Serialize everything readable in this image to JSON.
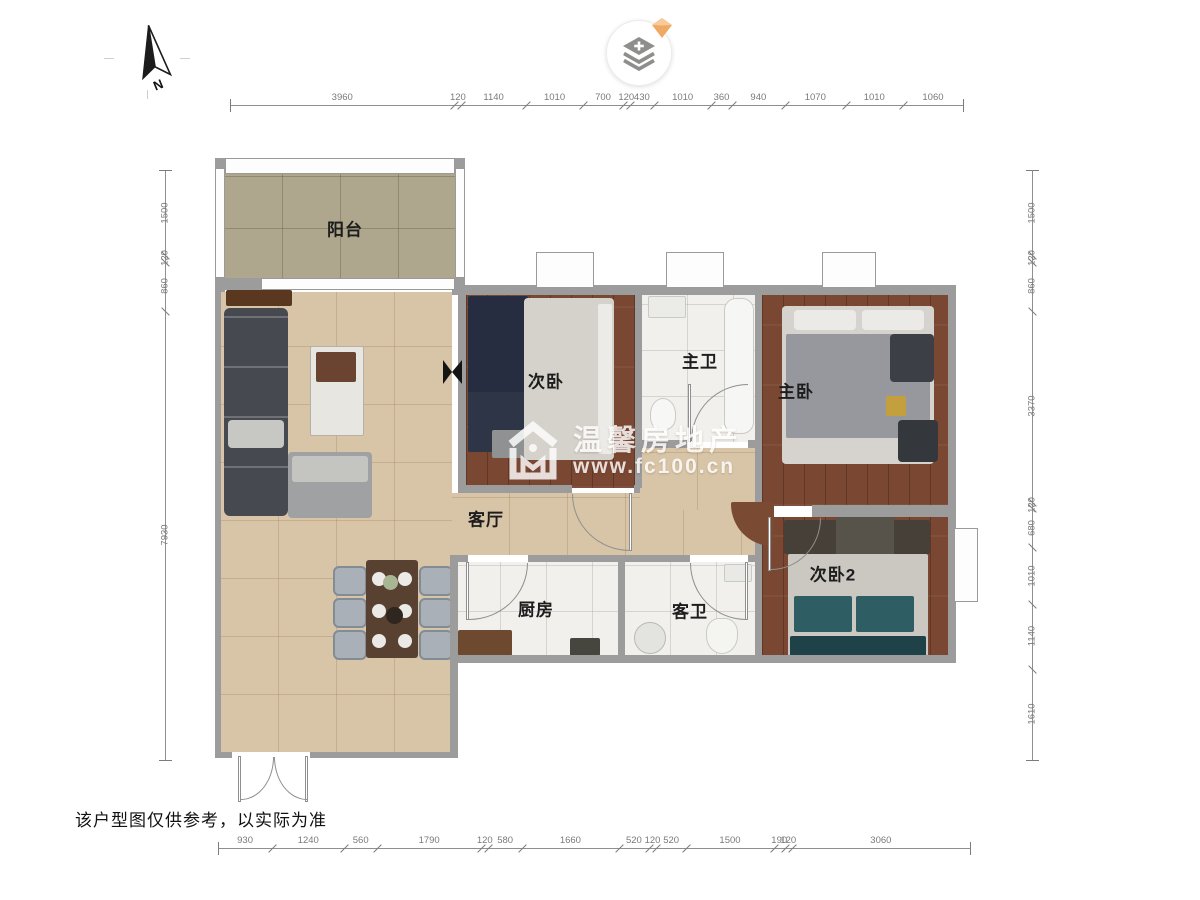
{
  "ui": {
    "compass_label": "N",
    "layers_button": {
      "icon": "layers-plus-icon",
      "badge_icon": "diamond-badge-icon"
    }
  },
  "rooms": [
    {
      "id": "balcony",
      "label": "阳台"
    },
    {
      "id": "bedroom-2",
      "label": "次卧"
    },
    {
      "id": "master-bath",
      "label": "主卫"
    },
    {
      "id": "master-bedroom",
      "label": "主卧"
    },
    {
      "id": "living-room",
      "label": "客厅"
    },
    {
      "id": "kitchen",
      "label": "厨房"
    },
    {
      "id": "guest-bath",
      "label": "客卫"
    },
    {
      "id": "bedroom-3",
      "label": "次卧2"
    }
  ],
  "watermark": {
    "brand": "温馨房地产",
    "url": "www.fc100.cn"
  },
  "disclaimer": "该户型图仅供参考，以实际为准",
  "dimensions": {
    "top": [
      3960,
      120,
      1140,
      1010,
      700,
      120,
      430,
      1010,
      360,
      940,
      1070,
      1010,
      1060
    ],
    "bottom": [
      930,
      1240,
      560,
      1790,
      120,
      580,
      1660,
      520,
      120,
      520,
      1500,
      190,
      120,
      3060
    ],
    "left": [
      1500,
      120,
      860,
      7930
    ],
    "right": [
      1500,
      120,
      860,
      3370,
      120,
      680,
      1010,
      1140,
      1610
    ]
  },
  "colors": {
    "wall": "#9c9c9c",
    "floor_wood": "#7a4732",
    "floor_tan": "#d8c5a7",
    "floor_balcony": "#aea78d",
    "floor_marble": "#f1f0ed",
    "watermark": "#ffffff",
    "badge": "#efa963",
    "icon_gray": "#8e8e8c",
    "dim_text": "#7a7a7a"
  }
}
